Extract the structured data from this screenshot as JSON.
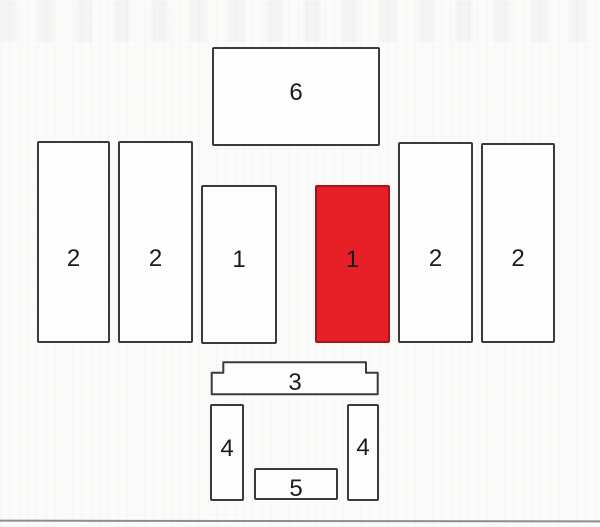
{
  "plan": {
    "highlight_color": "#e71f26",
    "outline_color": "#3a3a3a",
    "scan_edge_color": "#8d8d8d",
    "blocks": {
      "b6": {
        "label": "6",
        "selected": false
      },
      "b2_far_left": {
        "label": "2",
        "selected": false
      },
      "b2_left": {
        "label": "2",
        "selected": false
      },
      "b1_left": {
        "label": "1",
        "selected": false
      },
      "b1_selected": {
        "label": "1",
        "selected": true
      },
      "b2_right": {
        "label": "2",
        "selected": false
      },
      "b2_far_right": {
        "label": "2",
        "selected": false
      },
      "b3": {
        "label": "3",
        "selected": false
      },
      "b4_left": {
        "label": "4",
        "selected": false
      },
      "b4_right": {
        "label": "4",
        "selected": false
      },
      "b5": {
        "label": "5",
        "selected": false
      }
    }
  }
}
